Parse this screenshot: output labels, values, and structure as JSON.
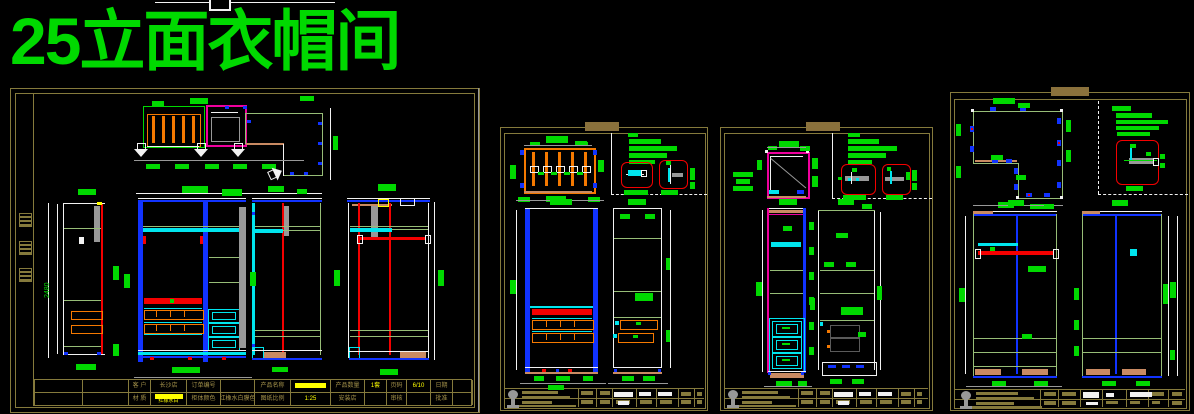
{
  "title": "25立面衣帽间",
  "dims": {
    "elevation_height": "2480"
  },
  "sheet1_titleblock": {
    "rows": [
      [
        {
          "t": "客 户",
          "s": "label"
        },
        {
          "t": "长沙店",
          "s": "label"
        },
        {
          "t": "订单编号",
          "s": "label"
        },
        {
          "t": "",
          "s": "blank"
        },
        {
          "t": "产品名称",
          "s": "label"
        },
        {
          "t": "",
          "s": "ybar"
        },
        {
          "t": "产品数量",
          "s": "label"
        },
        {
          "t": "1套",
          "s": "yel"
        },
        {
          "t": "页码",
          "s": "label"
        },
        {
          "t": "6/10",
          "s": "yel"
        },
        {
          "t": "日期",
          "s": "label"
        },
        {
          "t": "",
          "s": "blank"
        }
      ],
      [
        {
          "t": "材 质",
          "s": "label"
        },
        {
          "t": "红橡水白",
          "s": "ybartext"
        },
        {
          "t": "柜体颜色",
          "s": "label"
        },
        {
          "t": "红橡水白膜色",
          "s": "label"
        },
        {
          "t": "图纸比例",
          "s": "label"
        },
        {
          "t": "1:25",
          "s": "yel"
        },
        {
          "t": "安装店",
          "s": "label"
        },
        {
          "t": "",
          "s": "blank"
        },
        {
          "t": "审核",
          "s": "label"
        },
        {
          "t": "",
          "s": "blank"
        },
        {
          "t": "批准",
          "s": "label"
        },
        {
          "t": "",
          "s": "blank"
        }
      ]
    ]
  },
  "colors": {
    "green": "#00d900",
    "olive": "#857a3c",
    "tab": "#8a713c",
    "yellow": "#ffff00",
    "red": "#f40000",
    "magenta": "#f0009e",
    "cyan": "#00e5ee",
    "blue": "#1133ff",
    "orange": "#f57900",
    "pale": "#97bd77",
    "salmon": "#c98a62",
    "gray": "#989898",
    "white": "#f2f2f2"
  }
}
